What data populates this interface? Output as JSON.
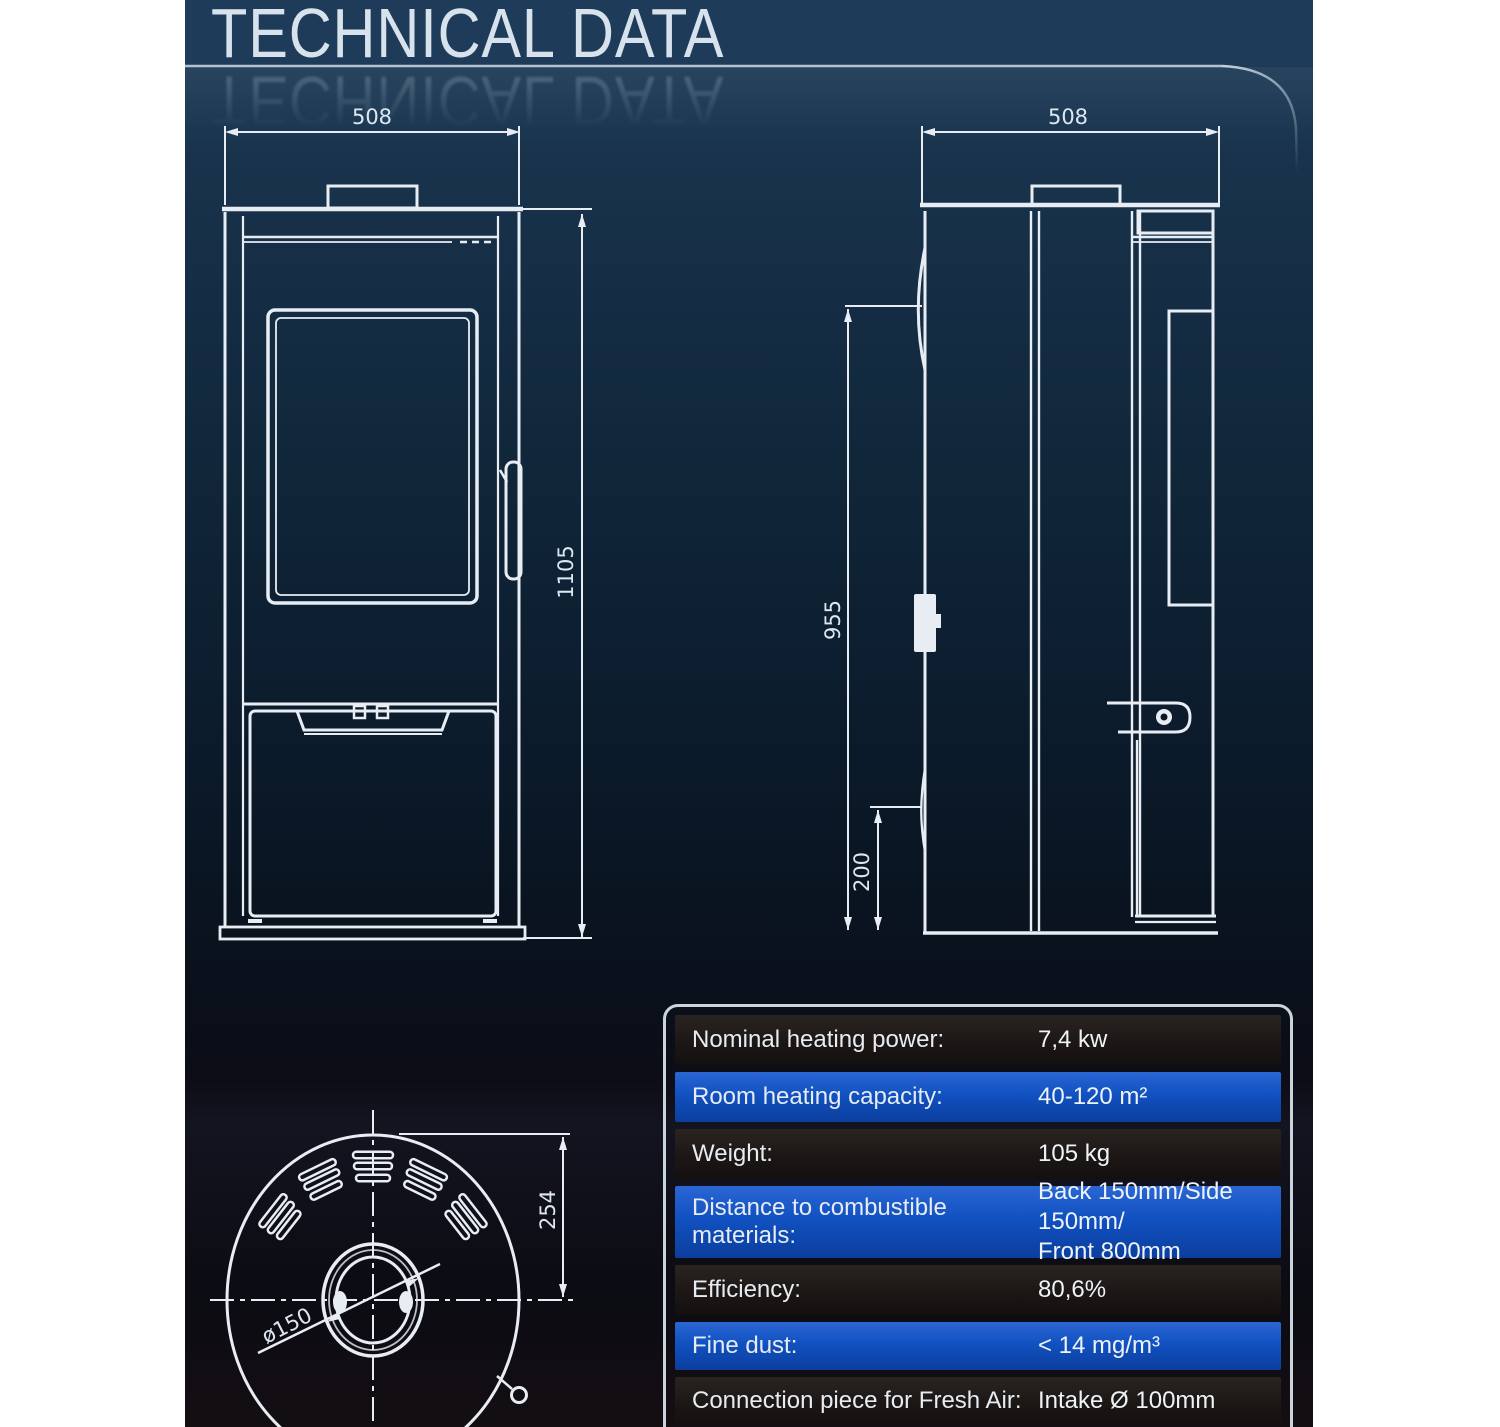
{
  "title": "TECHNICAL DATA",
  "drawings": {
    "front_view": {
      "width_label": "508",
      "height_label": "1105"
    },
    "side_view": {
      "depth_label": "508",
      "height_label": "955",
      "clearance_label": "200"
    },
    "top_view": {
      "radius_label": "254",
      "flue_label": "ø150"
    }
  },
  "table": {
    "rows": [
      {
        "label": "Nominal heating power:",
        "value": "7,4 kw"
      },
      {
        "label": "Room heating capacity:",
        "value": "40-120 m²"
      },
      {
        "label": "Weight:",
        "value": "105 kg"
      },
      {
        "label": "Distance to combustible materials:",
        "value": "Back 150mm/Side 150mm/\nFront 800mm"
      },
      {
        "label": "Efficiency:",
        "value": "80,6%"
      },
      {
        "label": "Fine dust:",
        "value": "< 14 mg/m³"
      },
      {
        "label": "Connection piece for Fresh Air:",
        "value": "Intake Ø 100mm"
      },
      {
        "label": "",
        "value": ""
      }
    ]
  }
}
